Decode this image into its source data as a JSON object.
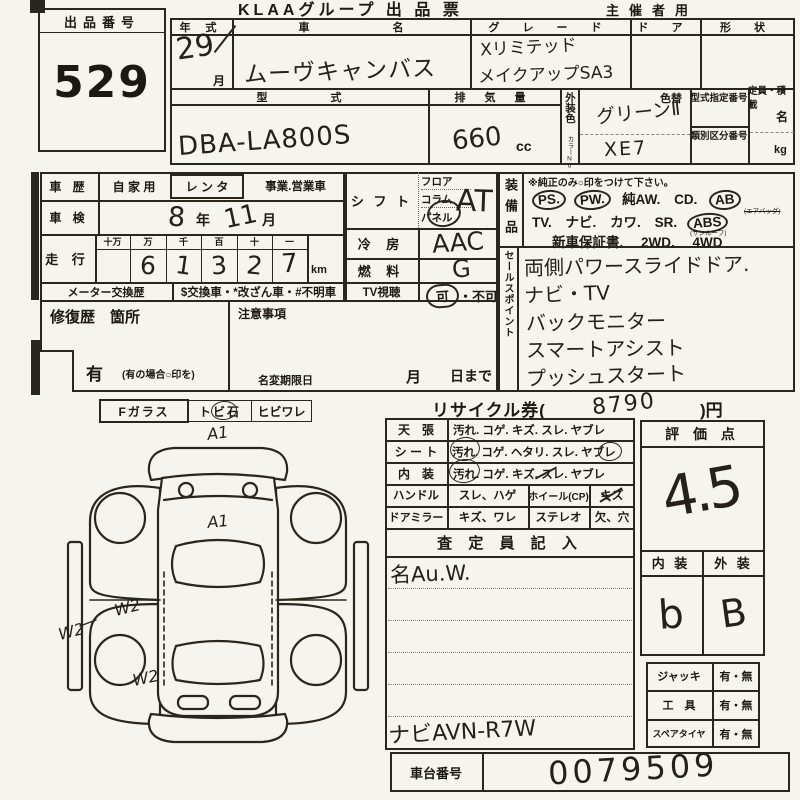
{
  "page": {
    "title": "KLAAグループ 出 品 票",
    "organizer": "主催者用"
  },
  "lot": {
    "label": "出品番号",
    "number": "529"
  },
  "v": {
    "year_label": "年 式",
    "year": "29",
    "month_printed": "月",
    "name_label": "車 名",
    "name": "ムーヴキャンバス",
    "grade_label": "グ レ ー ド",
    "grade1": "Xリミテッド",
    "grade2": "メイクアップSA3",
    "door_label": "ド ア",
    "shape_label": "形 状",
    "model_label": "型 式",
    "model": "DBA-LA800S",
    "disp_label": "排 気 量",
    "disp": "660",
    "disp_unit": "cc",
    "color_label": "外装色",
    "color_no": "カラーNo.",
    "color_change": "色替",
    "color": "グリーンⅡ",
    "color_code": "XE7",
    "type_no": "型式指定番号",
    "class_no": "類別区分番号",
    "cap_label": "定員・積載",
    "cap_unit1": "名",
    "cap_unit2": "kg"
  },
  "hist": {
    "label": "車 歴",
    "private": "自 家 用",
    "rental": "レ ン タ",
    "business": "事業.営業車",
    "shaken_label": "車 検",
    "shaken_year": "8",
    "nen": "年",
    "shaken_month": "11",
    "tsuki": "月",
    "mileage_label": "走 行",
    "digit_labels": [
      "十万",
      "万",
      "千",
      "百",
      "十",
      "一"
    ],
    "digits": [
      "",
      "6",
      "1",
      "3",
      "2",
      "7"
    ],
    "km": "km",
    "meter_label": "メーター交換歴",
    "meter_note": "$交換車・*改ざん車・#不明車"
  },
  "ctrl": {
    "shift_label": "シ フ ト",
    "shift_opts": [
      "フロア",
      "コラム",
      "パネル"
    ],
    "shift_val": "AT",
    "ac_label": "冷 房",
    "ac_val": "AAC",
    "fuel_label": "燃 料",
    "fuel_val": "G",
    "tv_label": "TV視聴",
    "tv_ok": "可",
    "tv_sep": "・",
    "tv_ng": "不可"
  },
  "equip": {
    "label": "装備品",
    "note": "※純正のみ○印をつけて下さい。",
    "r1": [
      "PS.",
      "PW.",
      "純AW.",
      "CD.",
      "AB"
    ],
    "ab_sub": "(エアバッグ)",
    "r2": [
      "TV.",
      "ナビ.",
      "カワ.",
      "SR.",
      "ABS"
    ],
    "sr_sub": "(サンルーフ)",
    "r3": [
      "新車保証書.",
      "2WD.",
      "4WD"
    ]
  },
  "sales": {
    "label": "セールスポイント",
    "lines": [
      "両側パワースライドドア.",
      "ナビ・TV",
      "バックモニター",
      "スマートアシスト",
      "プッシュスタート"
    ]
  },
  "repair": {
    "label": "修復歴　箇所",
    "notes": "注意事項",
    "has": "有",
    "has_note": "(有の場合○印を)",
    "name_change": "名変期限日",
    "month": "月",
    "day": "日まで"
  },
  "recycle": {
    "prefix": "リサイクル券(",
    "value": "8790",
    "suffix": ")円"
  },
  "glass": {
    "label": "Fガラス",
    "opt1": "トビ石",
    "opt2": "ヒビワレ"
  },
  "diagram": {
    "mark_front": "A1",
    "mark_hood": "A1",
    "mark_w1": "W2",
    "mark_w2": "W2",
    "mark_w3": "W2"
  },
  "cond": {
    "rows": [
      {
        "label": "天　張",
        "o": [
          "汚れ.",
          "コゲ.",
          "キズ.",
          "スレ.",
          "ヤブレ"
        ]
      },
      {
        "label": "シ ー ト",
        "o": [
          "汚れ.",
          "コゲ.",
          "ヘタリ.",
          "スレ.",
          "ヤブレ"
        ]
      },
      {
        "label": "内　装",
        "o": [
          "汚れ.",
          "コゲ.",
          "キズ.",
          "スレ.",
          "ヤブレ"
        ]
      }
    ],
    "handle": "ハンドル",
    "handle_o": "スレ、ハゲ",
    "wheel": "ホイール(CP)",
    "wheel_o": "キズ",
    "mirror": "ドアミラー",
    "mirror_o": "キズ、ワレ",
    "stereo": "ステレオ",
    "stereo_o": "欠、穴",
    "inspector": "査 定 員 記 入",
    "memo_top": "名Au.W.",
    "memo_bottom": "ナビAVN-R7W"
  },
  "eval": {
    "label": "評 価 点",
    "score": "4.5",
    "int_label": "内 装",
    "ext_label": "外 装",
    "int_grade": "b",
    "ext_grade": "B",
    "jack": "ジャッキ",
    "tool": "工　具",
    "spare": "スペアタイヤ",
    "yes_no": "有・無"
  },
  "chassis": {
    "label": "車台番号",
    "value": "0079509"
  }
}
